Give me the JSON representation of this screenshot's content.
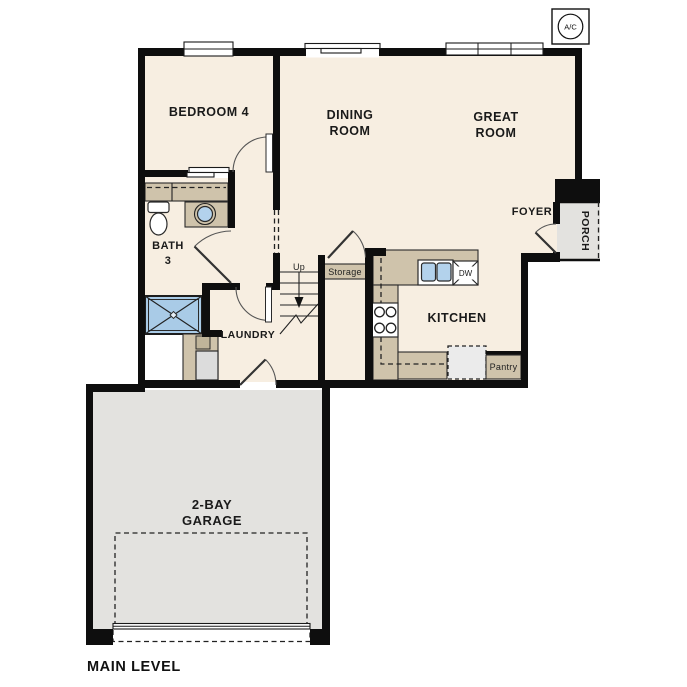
{
  "title": "MAIN LEVEL",
  "ac_unit": {
    "label": "A/C"
  },
  "rooms": {
    "bedroom4": {
      "label": "BEDROOM 4"
    },
    "dining": {
      "line1": "DINING",
      "line2": "ROOM"
    },
    "great": {
      "line1": "GREAT",
      "line2": "ROOM"
    },
    "kitchen": {
      "label": "KITCHEN"
    },
    "foyer": {
      "label": "FOYER"
    },
    "porch": {
      "label": "PORCH"
    },
    "bath3": {
      "line1": "BATH",
      "line2": "3"
    },
    "laundry": {
      "label": "LAUNDRY"
    },
    "storage": {
      "label": "Storage"
    },
    "pantry": {
      "label": "Pantry"
    },
    "garage": {
      "line1": "2-BAY",
      "line2": "GARAGE"
    }
  },
  "annotations": {
    "stairs_direction": "Up",
    "dishwasher": "DW"
  },
  "colors": {
    "wall": "#0e0e0e",
    "floor": "#f7eee1",
    "garage": "#e3e2df",
    "porch": "#e3e2df",
    "counter": "#cfc3ab",
    "counter-dark": "#bfb49a",
    "shower": "#a9cbe7",
    "sinkblue": "#b3d2ec",
    "appliance": "#dcdcdc",
    "fridge": "#ebebeb",
    "line": "#222222"
  }
}
